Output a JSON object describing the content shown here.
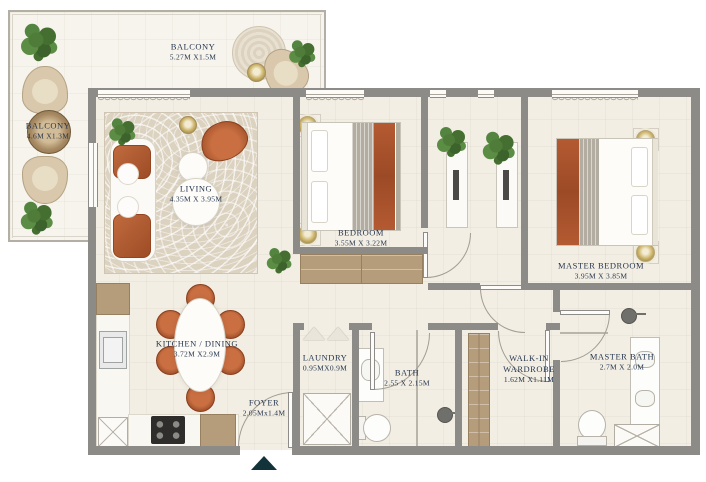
{
  "plan_type": "apartment-floor-plan",
  "rooms": [
    {
      "id": "balcony-top",
      "name": "BALCONY",
      "dims": "5.27M X1.5M"
    },
    {
      "id": "balcony-left",
      "name": "BALCONY",
      "dims": "4.6M X1.3M"
    },
    {
      "id": "living",
      "name": "LIVING",
      "dims": "4.35M X 3.95M"
    },
    {
      "id": "bedroom",
      "name": "BEDROOM",
      "dims": "3.55M X 3.22M"
    },
    {
      "id": "master-bedroom",
      "name": "MASTER BEDROOM",
      "dims": "3.95M X 3.85M"
    },
    {
      "id": "kitchen-dining",
      "name": "KITCHEN / DINING",
      "dims": "3.72M X2.9M"
    },
    {
      "id": "laundry",
      "name": "LAUNDRY",
      "dims": "0.95MX0.9M"
    },
    {
      "id": "bath",
      "name": "BATH",
      "dims": "2.55 X 2.15M"
    },
    {
      "id": "walk-in-wardrobe",
      "name": "WALK-IN WARDROBE",
      "dims": "1.62M X1.11M"
    },
    {
      "id": "master-bath",
      "name": "MASTER BATH",
      "dims": "2.7M X 2.0M"
    },
    {
      "id": "foyer",
      "name": "FOYER",
      "dims": "2.05Mx1.4M"
    }
  ],
  "icons": {
    "entrance_marker": "up-arrow-triangle"
  },
  "colors": {
    "wall": "#8d8b87",
    "floor": "#f2eee4",
    "balcony_floor": "#f7f4ed",
    "terracotta": "#b45a32",
    "wood": "#b59d7c",
    "gold": "#cdb369",
    "plant_green": "#4f7d39",
    "label_text": "#26364e",
    "entry_arrow": "#13333b"
  }
}
